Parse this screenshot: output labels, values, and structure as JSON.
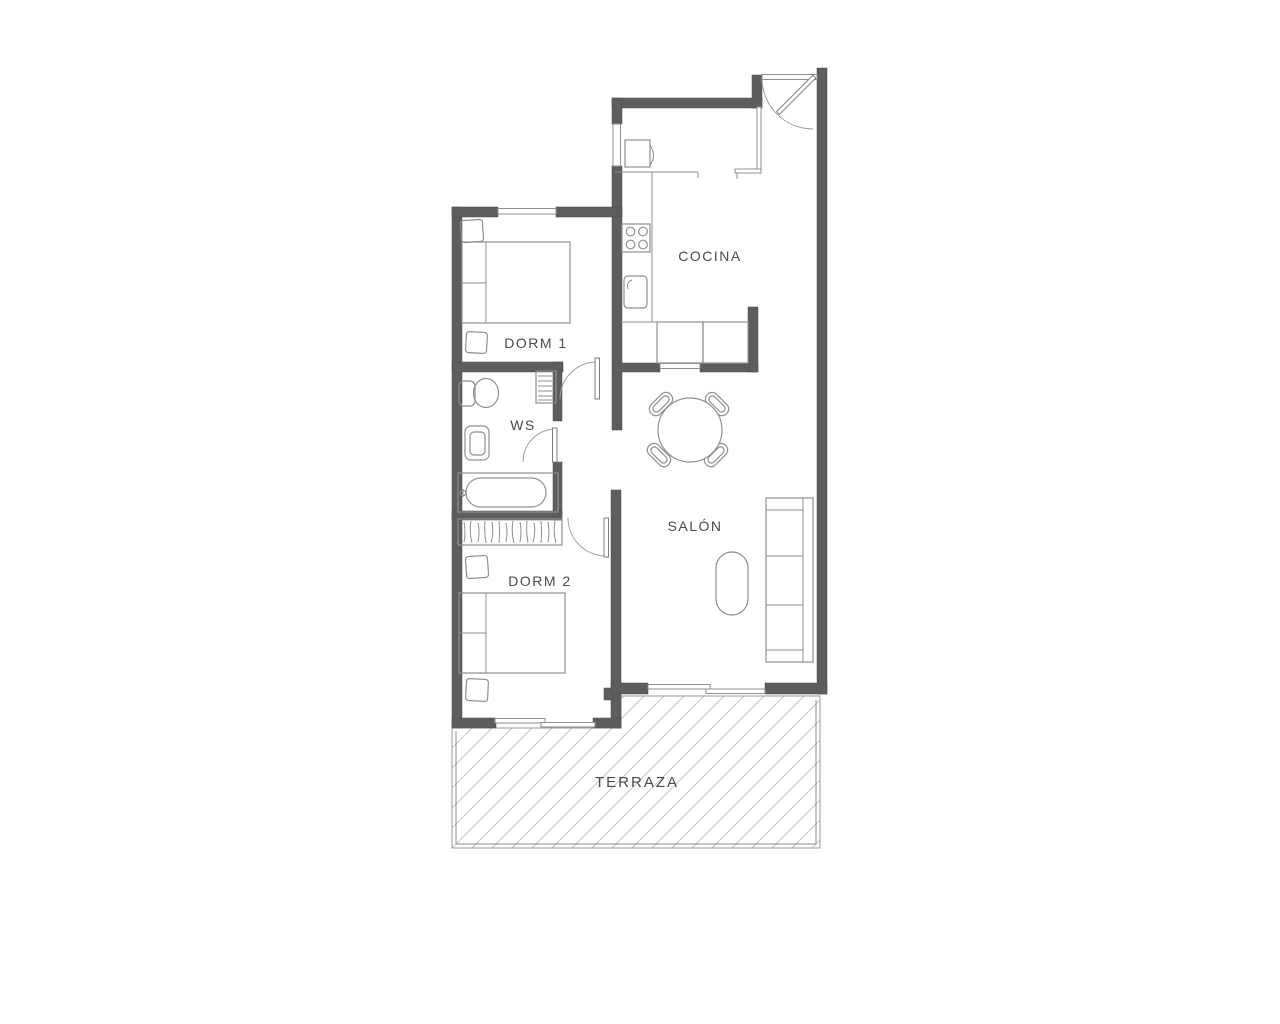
{
  "floorplan": {
    "rooms": [
      {
        "id": "cocina",
        "label": "COCINA"
      },
      {
        "id": "dorm1",
        "label": "DORM 1"
      },
      {
        "id": "ws",
        "label": "WS"
      },
      {
        "id": "salon",
        "label": "SALÓN"
      },
      {
        "id": "dorm2",
        "label": "DORM 2"
      },
      {
        "id": "terraza",
        "label": "TERRAZA"
      }
    ],
    "colors": {
      "wall": "#5d5d5d",
      "furniture_line": "#8f8f8f",
      "label_text": "#4a4a4a",
      "hatch": "#c4c4c4",
      "background": "#ffffff"
    }
  }
}
